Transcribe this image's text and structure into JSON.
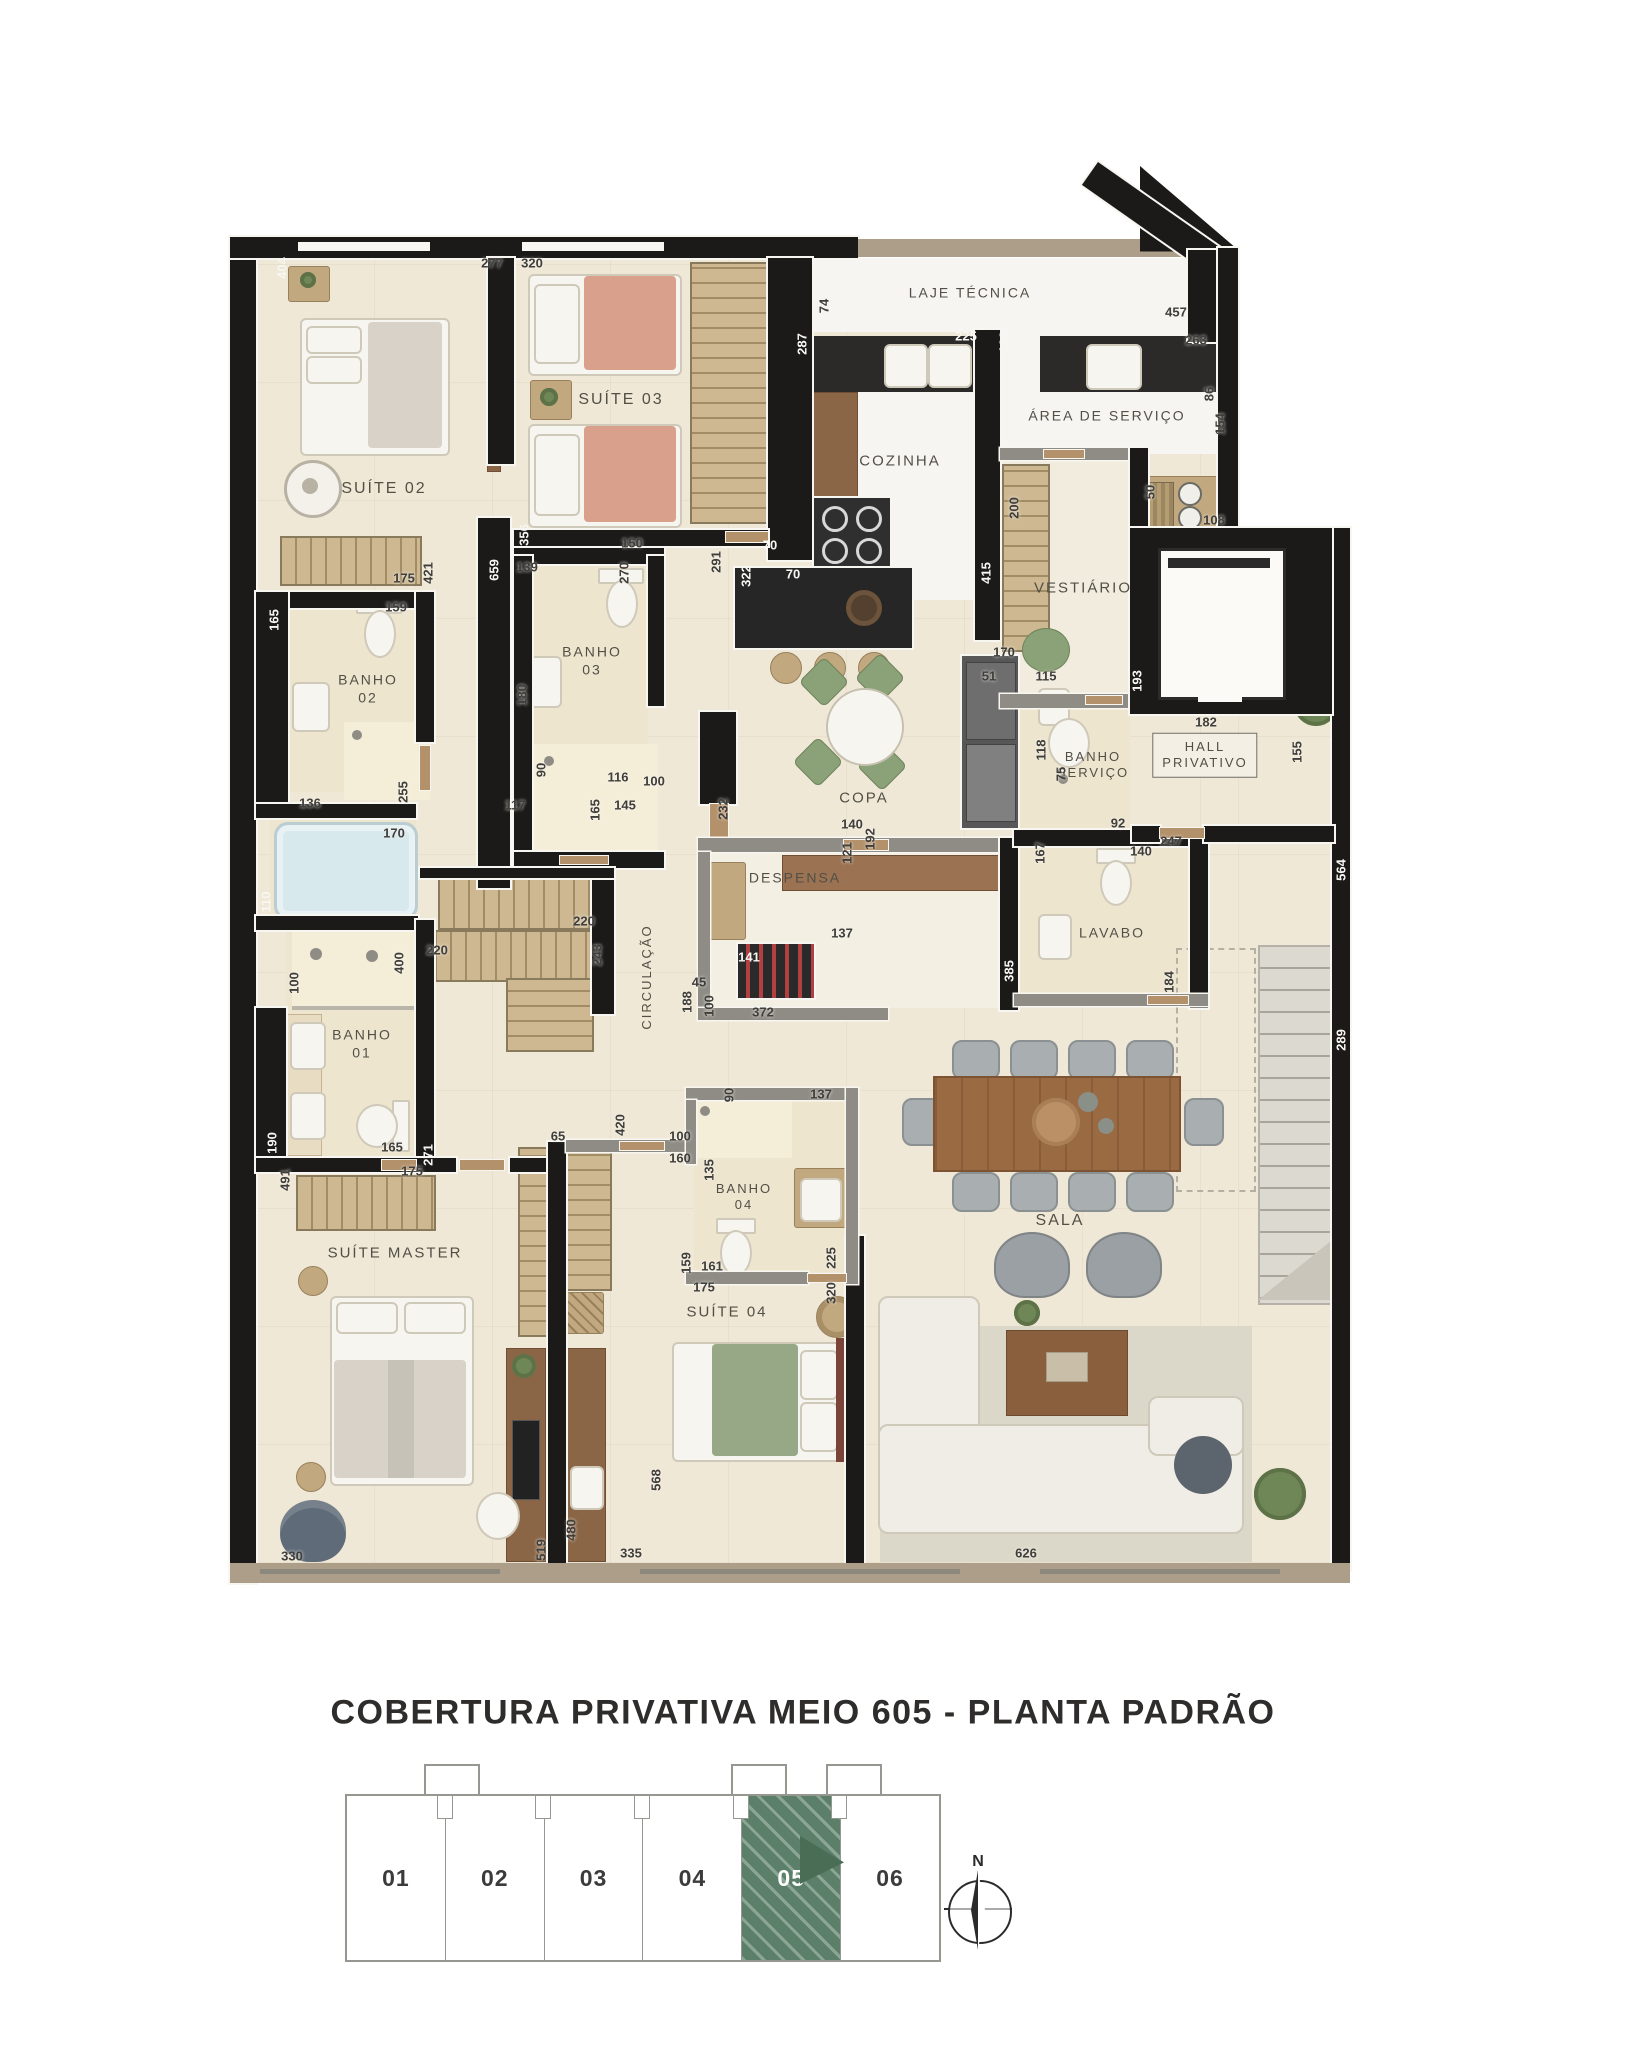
{
  "title": "COBERTURA PRIVATIVA MEIO 605 - PLANTA PADRÃO",
  "compass": {
    "label": "N"
  },
  "unit_selector": {
    "units": [
      {
        "label": "01",
        "selected": false
      },
      {
        "label": "02",
        "selected": false
      },
      {
        "label": "03",
        "selected": false
      },
      {
        "label": "04",
        "selected": false
      },
      {
        "label": "05",
        "selected": true
      },
      {
        "label": "06",
        "selected": false
      }
    ],
    "selected_color": "#5b7f68"
  },
  "plan": {
    "wall_color": "#1b1a18",
    "floor_color": "#f0e8d6",
    "rooms": [
      {
        "t": "SUÍTE 02",
        "x": 384,
        "y": 489
      },
      {
        "t": "SUÍTE 03",
        "x": 621,
        "y": 400
      },
      {
        "t": "LAJE TÉCNICA",
        "x": 970,
        "y": 293,
        "fs": 14
      },
      {
        "t": "COZINHA",
        "x": 900,
        "y": 462,
        "fs": 15
      },
      {
        "t": "ÁREA DE SERVIÇO",
        "x": 1107,
        "y": 416,
        "fs": 14
      },
      {
        "t": "VESTIÁRIO",
        "x": 1083,
        "y": 589,
        "fs": 15
      },
      {
        "t": "BANHO\n02",
        "x": 368,
        "y": 689,
        "fs": 14
      },
      {
        "t": "BANHO\n03",
        "x": 592,
        "y": 661,
        "fs": 14
      },
      {
        "t": "BANHO\nSERVIÇO",
        "x": 1093,
        "y": 765,
        "fs": 13
      },
      {
        "t": "HALL\nPRIVATIVO",
        "x": 1205,
        "y": 755,
        "box": true
      },
      {
        "t": "COPA",
        "x": 864,
        "y": 799,
        "fs": 15
      },
      {
        "t": "DESPENSA",
        "x": 795,
        "y": 878,
        "fs": 14
      },
      {
        "t": "LAVABO",
        "x": 1112,
        "y": 933,
        "fs": 14
      },
      {
        "t": "CIRCULAÇÃO",
        "x": 647,
        "y": 977,
        "v": true,
        "fs": 13
      },
      {
        "t": "BANHO\n01",
        "x": 362,
        "y": 1044,
        "fs": 14
      },
      {
        "t": "SUÍTE MASTER",
        "x": 395,
        "y": 1254,
        "fs": 15
      },
      {
        "t": "BANHO\n04",
        "x": 744,
        "y": 1197,
        "fs": 13
      },
      {
        "t": "SUÍTE 04",
        "x": 727,
        "y": 1313,
        "fs": 15
      },
      {
        "t": "SALA",
        "x": 1060,
        "y": 1221
      }
    ],
    "dimensions": [
      {
        "t": "404",
        "x": 282,
        "y": 268,
        "v": true,
        "w": true
      },
      {
        "t": "277",
        "x": 492,
        "y": 263
      },
      {
        "t": "320",
        "x": 532,
        "y": 263
      },
      {
        "t": "74",
        "x": 824,
        "y": 306,
        "v": true
      },
      {
        "t": "287",
        "x": 802,
        "y": 344,
        "v": true,
        "w": true
      },
      {
        "t": "225",
        "x": 966,
        "y": 336,
        "w": true
      },
      {
        "t": "190",
        "x": 1004,
        "y": 342,
        "v": true,
        "w": true
      },
      {
        "t": "457",
        "x": 1176,
        "y": 312
      },
      {
        "t": "263",
        "x": 1196,
        "y": 340
      },
      {
        "t": "86",
        "x": 1209,
        "y": 394,
        "v": true
      },
      {
        "t": "154",
        "x": 1220,
        "y": 424,
        "v": true
      },
      {
        "t": "108",
        "x": 1214,
        "y": 520
      },
      {
        "t": "50",
        "x": 1150,
        "y": 492,
        "v": true
      },
      {
        "t": "356",
        "x": 524,
        "y": 535,
        "v": true,
        "w": true
      },
      {
        "t": "150",
        "x": 632,
        "y": 543
      },
      {
        "t": "139",
        "x": 527,
        "y": 567
      },
      {
        "t": "270",
        "x": 624,
        "y": 573,
        "v": true
      },
      {
        "t": "659",
        "x": 494,
        "y": 570,
        "v": true,
        "w": true
      },
      {
        "t": "291",
        "x": 716,
        "y": 562,
        "v": true
      },
      {
        "t": "322",
        "x": 746,
        "y": 576,
        "v": true,
        "w": true
      },
      {
        "t": "70",
        "x": 770,
        "y": 545,
        "w": true
      },
      {
        "t": "70",
        "x": 793,
        "y": 574,
        "w": true
      },
      {
        "t": "421",
        "x": 428,
        "y": 573,
        "v": true
      },
      {
        "t": "175",
        "x": 404,
        "y": 578
      },
      {
        "t": "165",
        "x": 274,
        "y": 620,
        "v": true,
        "w": true
      },
      {
        "t": "159",
        "x": 396,
        "y": 607
      },
      {
        "t": "180",
        "x": 522,
        "y": 695,
        "v": true
      },
      {
        "t": "200",
        "x": 1014,
        "y": 508,
        "v": true
      },
      {
        "t": "415",
        "x": 986,
        "y": 573,
        "v": true,
        "w": true
      },
      {
        "t": "170",
        "x": 1004,
        "y": 652
      },
      {
        "t": "51",
        "x": 989,
        "y": 676
      },
      {
        "t": "115",
        "x": 1046,
        "y": 676
      },
      {
        "t": "193",
        "x": 1137,
        "y": 681,
        "v": true,
        "w": true
      },
      {
        "t": "182",
        "x": 1206,
        "y": 722
      },
      {
        "t": "155",
        "x": 1297,
        "y": 752,
        "v": true
      },
      {
        "t": "136",
        "x": 310,
        "y": 803
      },
      {
        "t": "255",
        "x": 403,
        "y": 792,
        "v": true
      },
      {
        "t": "170",
        "x": 394,
        "y": 833
      },
      {
        "t": "110",
        "x": 266,
        "y": 902,
        "v": true,
        "w": true
      },
      {
        "t": "220",
        "x": 584,
        "y": 921
      },
      {
        "t": "220",
        "x": 437,
        "y": 950
      },
      {
        "t": "243",
        "x": 597,
        "y": 955,
        "v": true
      },
      {
        "t": "90",
        "x": 541,
        "y": 770,
        "v": true
      },
      {
        "t": "116",
        "x": 618,
        "y": 777
      },
      {
        "t": "100",
        "x": 654,
        "y": 781
      },
      {
        "t": "117",
        "x": 515,
        "y": 805
      },
      {
        "t": "165",
        "x": 595,
        "y": 810,
        "v": true
      },
      {
        "t": "145",
        "x": 625,
        "y": 805
      },
      {
        "t": "232",
        "x": 723,
        "y": 809,
        "v": true
      },
      {
        "t": "140",
        "x": 852,
        "y": 824
      },
      {
        "t": "192",
        "x": 870,
        "y": 839,
        "v": true
      },
      {
        "t": "121",
        "x": 847,
        "y": 853,
        "v": true
      },
      {
        "t": "137",
        "x": 842,
        "y": 933
      },
      {
        "t": "141",
        "x": 749,
        "y": 957,
        "w": true
      },
      {
        "t": "45",
        "x": 699,
        "y": 982
      },
      {
        "t": "188",
        "x": 687,
        "y": 1002,
        "v": true
      },
      {
        "t": "100",
        "x": 709,
        "y": 1006,
        "v": true
      },
      {
        "t": "372",
        "x": 763,
        "y": 1012
      },
      {
        "t": "385",
        "x": 1009,
        "y": 971,
        "v": true,
        "w": true
      },
      {
        "t": "167",
        "x": 1040,
        "y": 853,
        "v": true
      },
      {
        "t": "140",
        "x": 1141,
        "y": 851
      },
      {
        "t": "247",
        "x": 1171,
        "y": 841
      },
      {
        "t": "92",
        "x": 1118,
        "y": 823
      },
      {
        "t": "118",
        "x": 1041,
        "y": 750,
        "v": true
      },
      {
        "t": "75",
        "x": 1061,
        "y": 774,
        "v": true
      },
      {
        "t": "184",
        "x": 1169,
        "y": 982,
        "v": true
      },
      {
        "t": "564",
        "x": 1341,
        "y": 870,
        "v": true,
        "w": true
      },
      {
        "t": "289",
        "x": 1341,
        "y": 1040,
        "v": true,
        "w": true
      },
      {
        "t": "90",
        "x": 729,
        "y": 1095,
        "v": true
      },
      {
        "t": "137",
        "x": 821,
        "y": 1094
      },
      {
        "t": "100",
        "x": 680,
        "y": 1136
      },
      {
        "t": "160",
        "x": 680,
        "y": 1158
      },
      {
        "t": "65",
        "x": 558,
        "y": 1136
      },
      {
        "t": "420",
        "x": 620,
        "y": 1125,
        "v": true
      },
      {
        "t": "135",
        "x": 709,
        "y": 1170,
        "v": true
      },
      {
        "t": "159",
        "x": 686,
        "y": 1263,
        "v": true
      },
      {
        "t": "161",
        "x": 712,
        "y": 1266
      },
      {
        "t": "225",
        "x": 831,
        "y": 1258,
        "v": true
      },
      {
        "t": "320",
        "x": 831,
        "y": 1293,
        "v": true
      },
      {
        "t": "175",
        "x": 704,
        "y": 1287
      },
      {
        "t": "190",
        "x": 272,
        "y": 1143,
        "v": true,
        "w": true
      },
      {
        "t": "165",
        "x": 392,
        "y": 1147
      },
      {
        "t": "271",
        "x": 428,
        "y": 1155,
        "v": true,
        "w": true
      },
      {
        "t": "175",
        "x": 412,
        "y": 1171
      },
      {
        "t": "491",
        "x": 285,
        "y": 1180,
        "v": true
      },
      {
        "t": "330",
        "x": 292,
        "y": 1556
      },
      {
        "t": "519",
        "x": 541,
        "y": 1550,
        "v": true
      },
      {
        "t": "480",
        "x": 571,
        "y": 1530,
        "v": true
      },
      {
        "t": "568",
        "x": 656,
        "y": 1480,
        "v": true
      },
      {
        "t": "335",
        "x": 631,
        "y": 1553
      },
      {
        "t": "626",
        "x": 1026,
        "y": 1553
      },
      {
        "t": "100",
        "x": 294,
        "y": 983,
        "v": true
      },
      {
        "t": "400",
        "x": 399,
        "y": 963,
        "v": true
      }
    ]
  }
}
